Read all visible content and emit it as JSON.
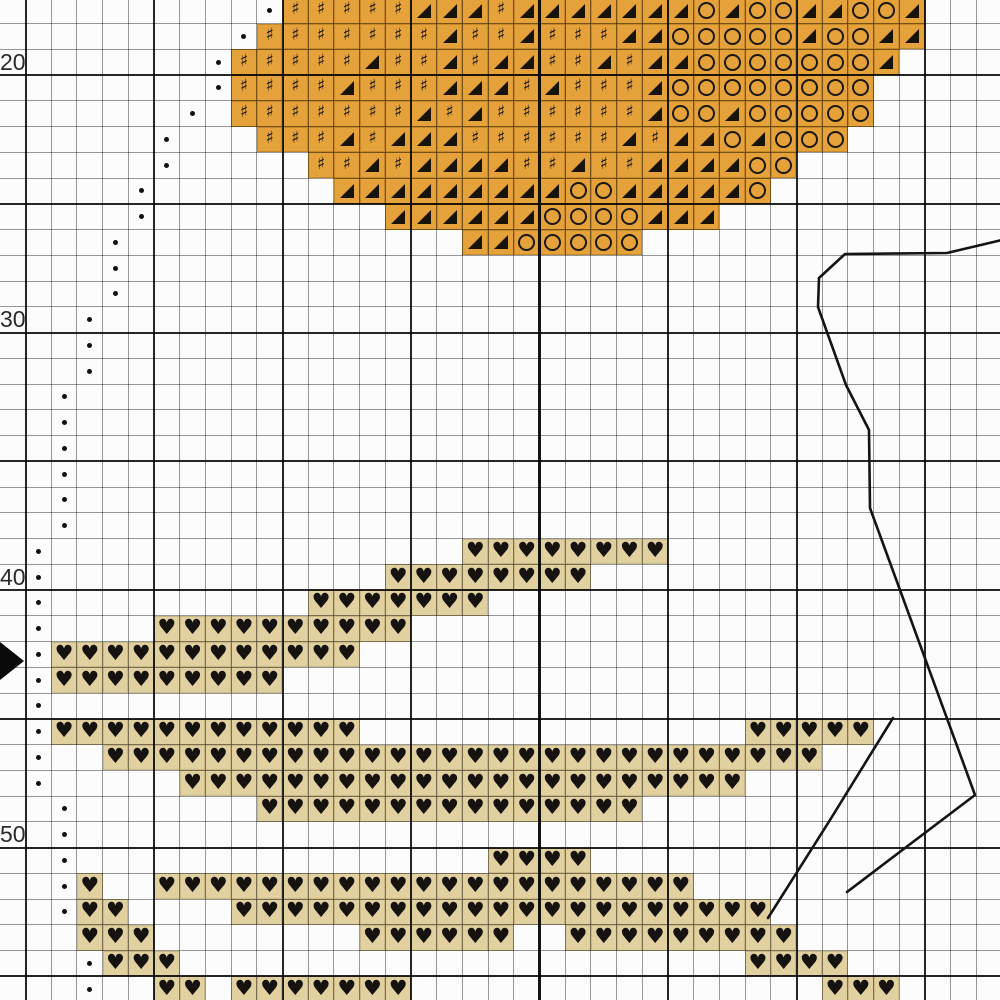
{
  "chart": {
    "type": "cross-stitch-pattern-grid",
    "grid": {
      "width": 1000,
      "height": 1000,
      "origin_x": 25.5,
      "origin_y": -2.25,
      "cell_w": 25.7,
      "cell_h": 25.75,
      "cols": 38,
      "rows": 39,
      "major_every": 5,
      "major_row_phase": 3,
      "center_col_line": 20
    },
    "row_labels": [
      {
        "text": "20",
        "y": 62
      },
      {
        "text": "30",
        "y": 319
      },
      {
        "text": "40",
        "y": 577
      },
      {
        "text": "50",
        "y": 834
      }
    ],
    "symbols": {
      "sharp": "♯",
      "triangle": "◢",
      "circle": "○",
      "heart": "♥",
      "dot": "•"
    },
    "colors": {
      "background": "#fcfcfc",
      "orange_fill": "#E5A23A",
      "tan_fill": "#E2D1A0",
      "symbol_ink": "#151210",
      "grid_minor": "#9b9b9b",
      "grid_major": "#1f1f1f",
      "backstitch": "#141414",
      "label_ink": "#2a2a2a"
    },
    "stitch_rows": [
      {
        "row": 0,
        "start": 10,
        "pattern": "HHHHHTTTHTTTTTTTCTCCTTCCT"
      },
      {
        "row": 1,
        "start": 9,
        "pattern": "HHHHHHHTHHTHHHTTCCCCCTCCTT"
      },
      {
        "row": 2,
        "start": 8,
        "pattern": "HHHHHTHHTHTTHHTHTTCCCCCCCT"
      },
      {
        "row": 3,
        "start": 8,
        "pattern": "HHHHTHHHTTTHTHHHTCCCCCCCC"
      },
      {
        "row": 4,
        "start": 8,
        "pattern": "HHHHHHHTHTHHHHHHTCCTCCCCC"
      },
      {
        "row": 5,
        "start": 9,
        "pattern": "HHHTHTTTHHHHHHTHTTCTCCC"
      },
      {
        "row": 6,
        "start": 11,
        "pattern": "HHTHTTTTHHTHHTTTTCC"
      },
      {
        "row": 7,
        "start": 12,
        "pattern": "TTTTTTTTTCCTTTTTC"
      },
      {
        "row": 8,
        "start": 14,
        "pattern": "TTTTTTCCCCTTT"
      },
      {
        "row": 9,
        "start": 17,
        "pattern": "TTCCCCC"
      }
    ],
    "heart_runs": [
      [
        21,
        17,
        24
      ],
      [
        22,
        14,
        21
      ],
      [
        23,
        11,
        17
      ],
      [
        24,
        5,
        14
      ],
      [
        25,
        1,
        12
      ],
      [
        26,
        1,
        9
      ],
      [
        28,
        1,
        12
      ],
      [
        28,
        28,
        32
      ],
      [
        29,
        3,
        30
      ],
      [
        30,
        6,
        27
      ],
      [
        31,
        9,
        23
      ],
      [
        33,
        18,
        21
      ],
      [
        34,
        2,
        2
      ],
      [
        34,
        5,
        25
      ],
      [
        35,
        2,
        3
      ],
      [
        35,
        8,
        28
      ],
      [
        36,
        2,
        4
      ],
      [
        36,
        13,
        18
      ],
      [
        36,
        21,
        29
      ],
      [
        37,
        3,
        5
      ],
      [
        37,
        28,
        31
      ],
      [
        38,
        5,
        6
      ],
      [
        38,
        8,
        14
      ],
      [
        38,
        31,
        33
      ]
    ],
    "dot_cells": [
      [
        0,
        9
      ],
      [
        1,
        8
      ],
      [
        2,
        7
      ],
      [
        3,
        7
      ],
      [
        4,
        6
      ],
      [
        5,
        5
      ],
      [
        6,
        5
      ],
      [
        7,
        4
      ],
      [
        8,
        4
      ],
      [
        9,
        3
      ],
      [
        10,
        3
      ],
      [
        11,
        3
      ],
      [
        12,
        2
      ],
      [
        13,
        2
      ],
      [
        14,
        2
      ],
      [
        15,
        1
      ],
      [
        16,
        1
      ],
      [
        17,
        1
      ],
      [
        18,
        1
      ],
      [
        19,
        1
      ],
      [
        20,
        1
      ],
      [
        21,
        0
      ],
      [
        22,
        0
      ],
      [
        23,
        0
      ],
      [
        24,
        0
      ],
      [
        25,
        0
      ],
      [
        26,
        0
      ],
      [
        27,
        0
      ],
      [
        28,
        0
      ],
      [
        29,
        0
      ],
      [
        30,
        0
      ],
      [
        31,
        1
      ],
      [
        32,
        1
      ],
      [
        33,
        1
      ],
      [
        34,
        1
      ],
      [
        35,
        1
      ],
      [
        36,
        2
      ],
      [
        37,
        2
      ],
      [
        38,
        2
      ]
    ],
    "backstitch_polylines": [
      [
        [
          1002,
          240
        ],
        [
          947,
          253
        ],
        [
          845,
          254
        ],
        [
          819,
          278
        ],
        [
          818,
          307
        ],
        [
          846,
          385
        ],
        [
          869,
          430
        ],
        [
          870,
          508
        ],
        [
          975,
          795
        ],
        [
          847,
          892
        ]
      ],
      [
        [
          893,
          718
        ],
        [
          830,
          820
        ],
        [
          768,
          918
        ]
      ]
    ],
    "center_arrow": {
      "points": "0,642 24,661 0,680"
    }
  }
}
